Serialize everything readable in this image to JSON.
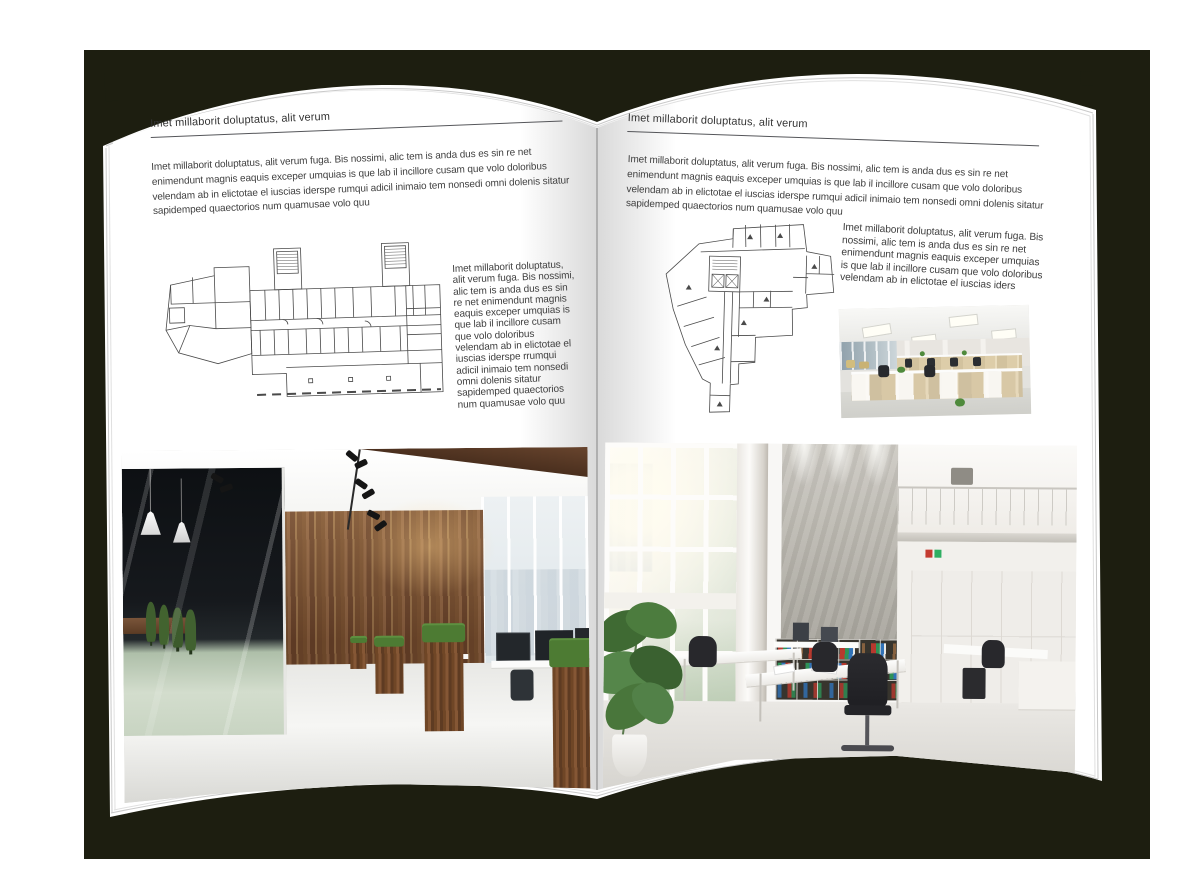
{
  "colors": {
    "backdrop": "#1d1e10",
    "paper": "#ffffff",
    "text": "#404040",
    "plan_line": "#4a4a4a"
  },
  "left_page": {
    "header": "Imet millaborit doluptatus, alit verum",
    "intro": "Imet millaborit doluptatus, alit verum fuga. Bis nossimi, alic tem is anda dus es sin re net enimendunt magnis eaquis exceper umquias is que lab il incillore cusam que volo doloribus velendam ab in elictotae el iuscias iderspe rumqui adicil inimaio tem nonsedi omni dolenis sitatur sapidemped quaectorios num quamusae volo quu",
    "caption": "Imet millaborit doluptatus, alit verum fuga. Bis nossimi, alic tem is anda dus es sin re net enimendunt magnis eaquis exceper umquias is que lab il incillore cusam que volo doloribus velendam ab in elictotae el iuscias iderspe rrumqui adicil inimaio tem nonsedi omni dolenis sitatur sapidemped quaectorios num quamusae volo quu"
  },
  "right_page": {
    "header": "Imet millaborit doluptatus, alit verum",
    "intro": "Imet millaborit doluptatus, alit verum fuga. Bis nossimi, alic tem is anda dus es sin re net enimendunt magnis eaquis exceper umquias is que lab il incillore cusam que volo doloribus velendam ab in elictotae el iuscias iderspe rumqui adicil inimaio tem nonsedi omni dolenis sitatur sapidemped quaectorios num quamusae volo quu",
    "caption": "Imet millaborit doluptatus, alit verum fuga. Bis nossimi, alic tem is anda dus es sin re net enimendunt magnis eaquis exceper umquias is que lab il incillore cusam que volo doloribus velendam ab in elictotae el iuscias iders"
  }
}
